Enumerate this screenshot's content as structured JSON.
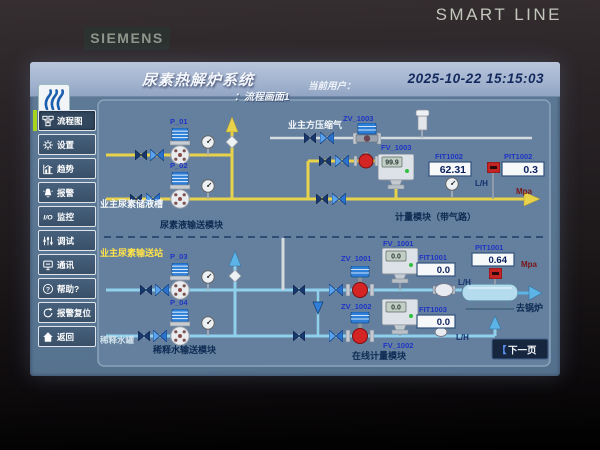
{
  "bezel": {
    "brand": "SIEMENS",
    "model": "SMART LINE"
  },
  "header": {
    "title": "尿素热解炉系统",
    "subtitle": "：流程画面1",
    "user_label": "当前用户：",
    "datetime": "2025-10-22  15:15:03"
  },
  "sidebar": {
    "items": [
      {
        "label": "流程图",
        "icon": "flow-diagram-icon",
        "active": true
      },
      {
        "label": "设置",
        "icon": "gear-icon",
        "active": false
      },
      {
        "label": "趋势",
        "icon": "trend-icon",
        "active": false
      },
      {
        "label": "报警",
        "icon": "alarm-bell-icon",
        "active": false
      },
      {
        "label": "监控",
        "icon": "io-icon",
        "active": false
      },
      {
        "label": "调试",
        "icon": "sliders-icon",
        "active": false
      },
      {
        "label": "通讯",
        "icon": "comm-icon",
        "active": false
      },
      {
        "label": "帮助?",
        "icon": "help-icon",
        "active": false
      },
      {
        "label": "报警复位",
        "icon": "alarm-reset-icon",
        "active": false
      },
      {
        "label": "返回",
        "icon": "home-icon",
        "active": false
      }
    ]
  },
  "process": {
    "urea_section": {
      "tank_label": "业主尿素储液槽",
      "module_label": "尿素液输送模块",
      "air_label": "业主方压缩气",
      "metering_label": "计量模块（带气路）",
      "pump1": "P_01",
      "pump2": "P_02",
      "zv_valve": "ZV_1003",
      "fv_valve": "FV_1003",
      "flowmeter_value": "99.9",
      "fit": {
        "tag": "FIT1002",
        "value": "62.31",
        "unit": "L/H"
      },
      "pit": {
        "tag": "PIT1002",
        "value": "0.3",
        "unit": "Mpa"
      }
    },
    "water_section": {
      "station_label": "业主尿素输送站",
      "tank_label": "稀释水罐",
      "module_label": "稀释水输送模块",
      "online_label": "在线计量模块",
      "to_boiler_label": "去锅炉",
      "pump1": "P_03",
      "pump2": "P_04",
      "urea_line": {
        "zv_valve": "ZV_1001",
        "fv_valve": "FV_1001",
        "fv_value": "0.0",
        "fit": {
          "tag": "FIT1001",
          "value": "0.0",
          "unit": "L/H"
        },
        "pit": {
          "tag": "PIT1001",
          "value": "0.64",
          "unit": "Mpa"
        }
      },
      "water_line": {
        "zv_valve": "ZV_1002",
        "fv_valve": "FV_1002",
        "fv_value": "0.0",
        "fit": {
          "tag": "FIT1003",
          "value": "0.0",
          "unit": "L/H"
        }
      }
    },
    "next_button": {
      "bracket": "【",
      "label": "下一页"
    }
  },
  "colors": {
    "urea_pipe": "#e8d24b",
    "water_pipe": "#8fd0ec",
    "air_pipe": "#d5dade",
    "valve_blue": "#2e7fd8",
    "valve_red": "#d42424",
    "active_indicator": "#a6d31f",
    "tag_text": "#1f35c4",
    "value_text": "#0a1f5c",
    "pressure_unit_text": "#7a1515"
  }
}
